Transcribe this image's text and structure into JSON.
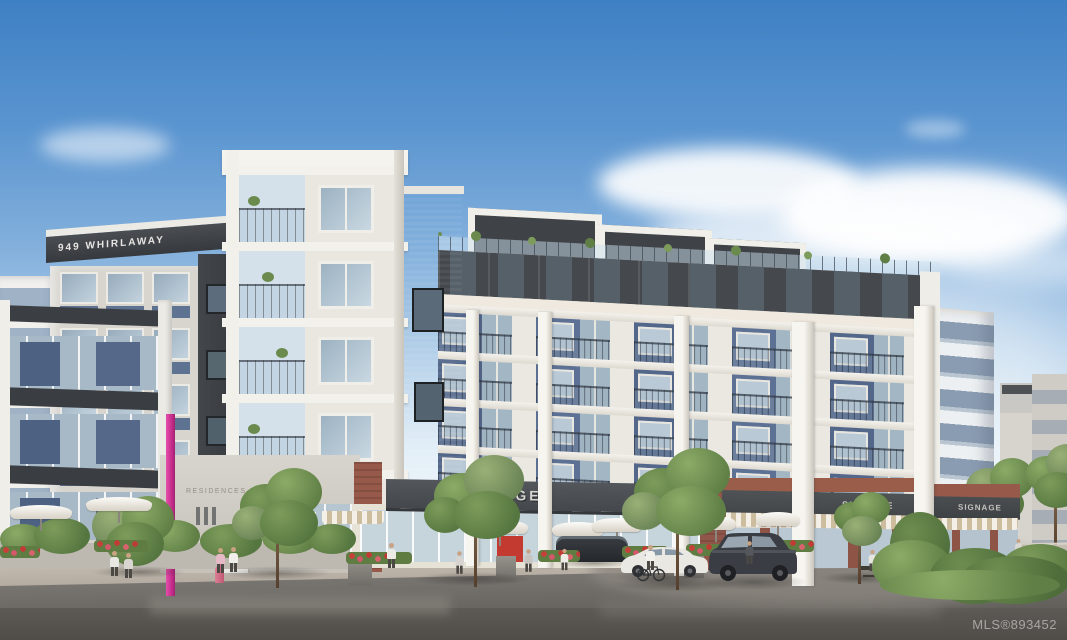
{
  "signs": {
    "building_address": "949 WHIRLAWAY",
    "residences_label": "RESIDENCES",
    "retail_fascia_center": "SIGNAGE",
    "retail_fascia_right_first": "SIGNAGE",
    "retail_fascia_right_second": "SIGNAGE"
  },
  "watermark": {
    "mls_label": "MLS®893452"
  },
  "palette": {
    "sky_top": "#3e80c4",
    "sky_horizon": "#f2f7fa",
    "cladding_charcoal": "#3d4145",
    "panel_slate_blue": "#5b6f92",
    "concrete_white": "#f2f0ea",
    "brick_red": "#96594a",
    "accent_magenta": "#d8399b",
    "asphalt_gray": "#5f5c58",
    "foliage_green": "#6b8a4e"
  }
}
